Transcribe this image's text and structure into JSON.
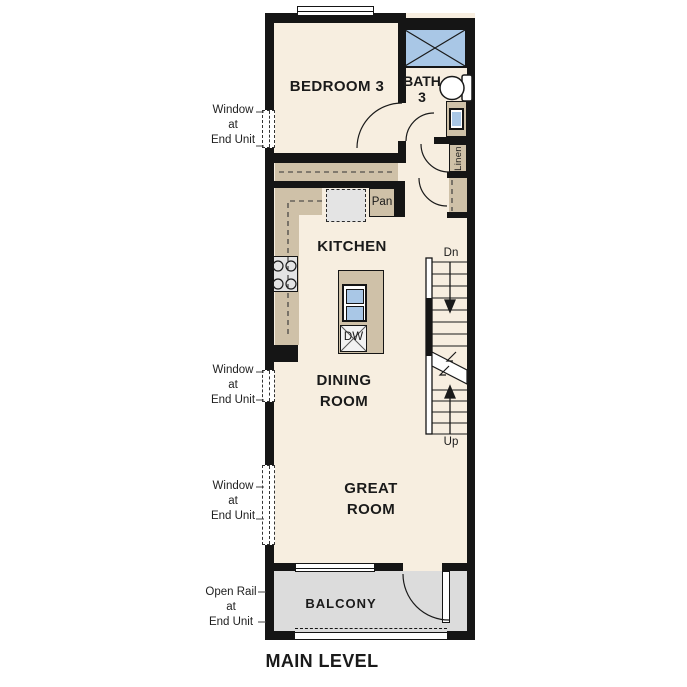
{
  "title": "MAIN LEVEL",
  "colors": {
    "floor": "#F7EEE0",
    "cabinet_tan": "#CFC1A8",
    "appliance_gray": "#E4E4E4",
    "balcony_gray": "#DCDCDC",
    "fixture_blue": "#A9C7E6",
    "wall_black": "#151515",
    "text_dark": "#1A1A1A"
  },
  "rooms": {
    "bedroom3": "BEDROOM 3",
    "bath3": "BATH\n3",
    "kitchen": "KITCHEN",
    "dining": "DINING\nROOM",
    "great": "GREAT\nROOM",
    "balcony": "BALCONY"
  },
  "labels": {
    "pantry": "Pan",
    "dishwasher": "DW",
    "linen": "Linen",
    "stairs_down": "Dn",
    "stairs_up": "Up"
  },
  "annotations": {
    "window_top": "Window\nat\nEnd Unit",
    "window_mid": "Window\nat\nEnd Unit",
    "window_bottom": "Window\nat\nEnd Unit",
    "open_rail": "Open Rail\nat\nEnd Unit"
  }
}
